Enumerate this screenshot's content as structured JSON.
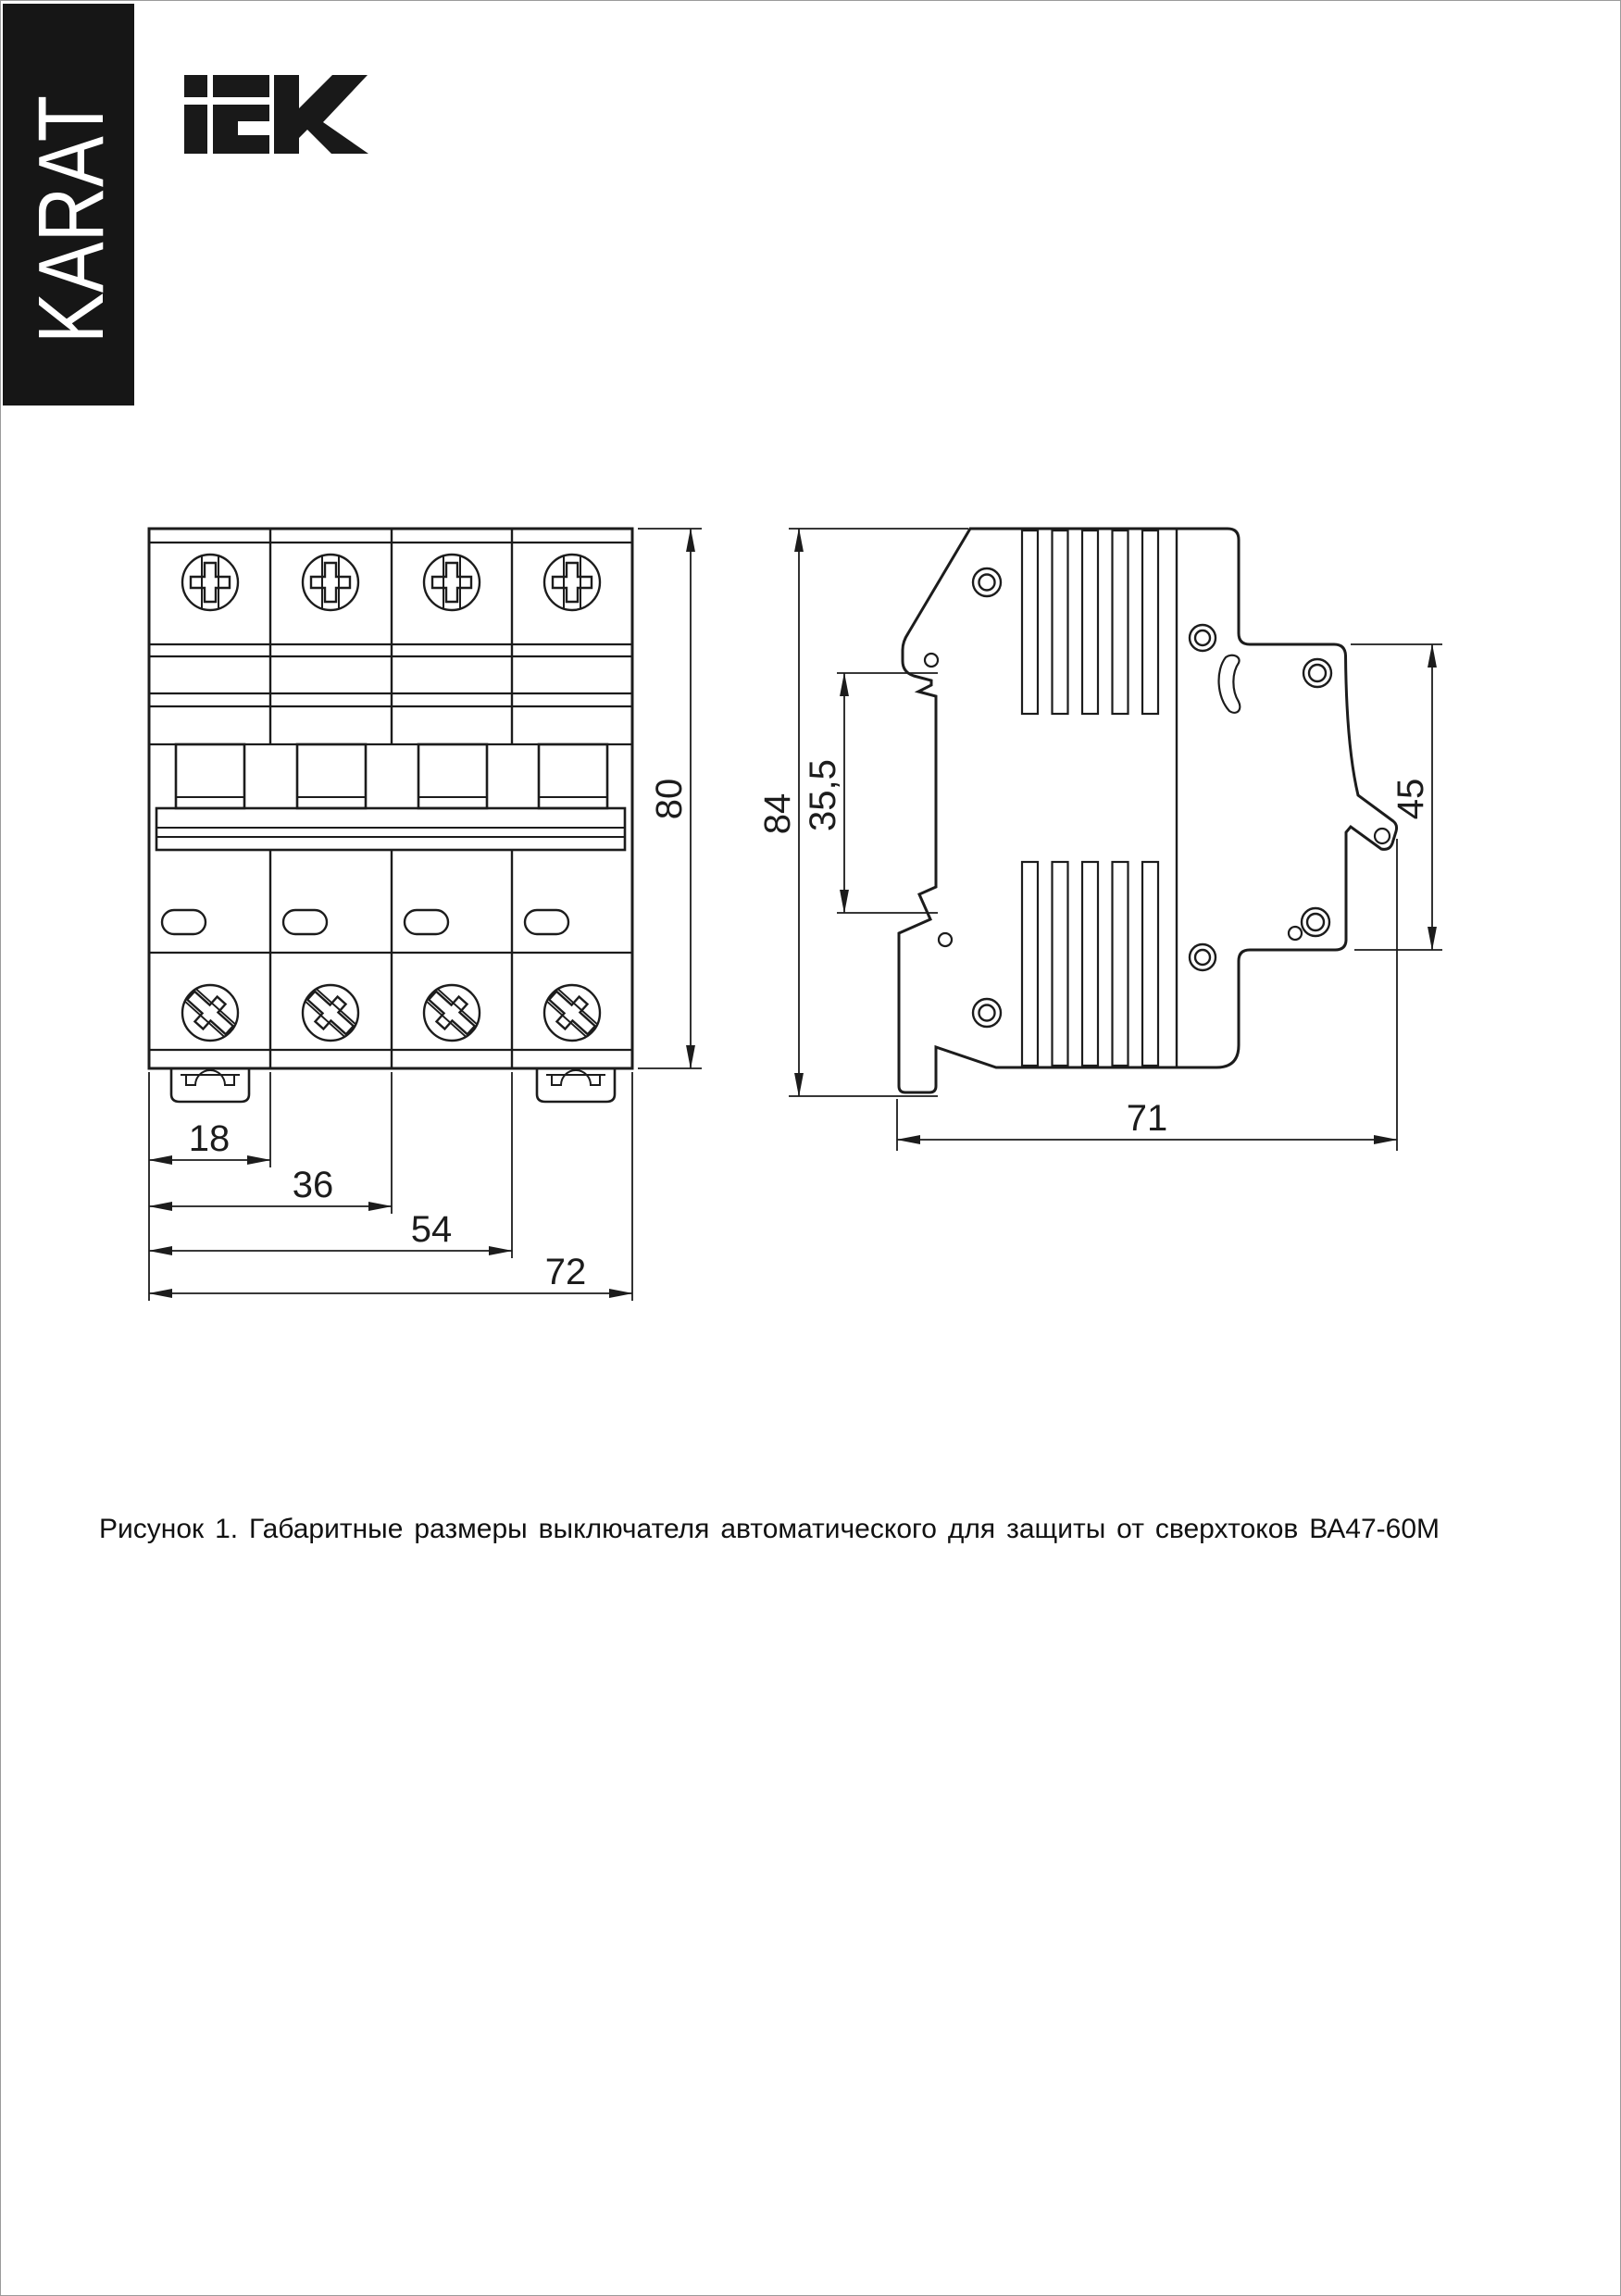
{
  "page": {
    "bg": "#ffffff",
    "line_color": "#1c1c1c",
    "banner_bg": "#161616",
    "banner_text_color": "#ffffff"
  },
  "sidebar": {
    "series_label": "KARAT"
  },
  "header": {
    "brand": "iEK"
  },
  "figure": {
    "caption": "Рисунок 1. Габаритные размеры выключателя автоматического для защиты от сверхтоков ВА47-60М",
    "front_view": {
      "dims": {
        "height": "80",
        "pole_pitch": "18",
        "two_poles": "36",
        "three_poles": "54",
        "total_width": "72"
      }
    },
    "side_view": {
      "dims": {
        "total_height": "84",
        "din_rail_recess": "35,5",
        "front_depth": "45",
        "total_depth": "71"
      }
    }
  }
}
